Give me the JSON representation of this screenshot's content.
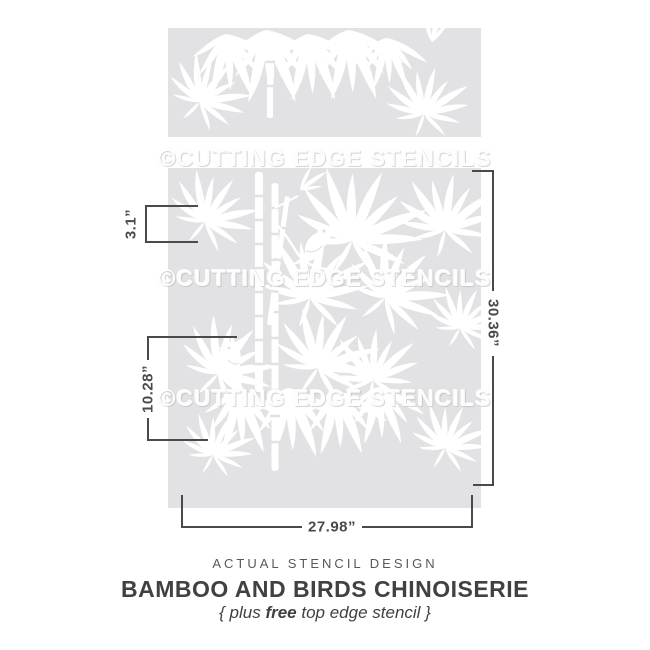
{
  "colors": {
    "stencil_fill": "#e2e2e4",
    "art_color": "#ffffff",
    "dim_line": "#4a4a4c",
    "kicker_text": "#58595b",
    "title_text": "#414042",
    "subtitle_text": "#414042",
    "page_bg": "#ffffff"
  },
  "watermark": {
    "text": "©CUTTING EDGE STENCILS"
  },
  "dimensions": {
    "top_stencil_height": "3.1”",
    "motif_height": "10.28”",
    "stencil_height": "30.36”",
    "stencil_width": "27.98”"
  },
  "caption": {
    "kicker": "ACTUAL STENCIL DESIGN",
    "title": "BAMBOO AND BIRDS CHINOISERIE",
    "subtitle_prefix": "{ plus ",
    "subtitle_emphasis": "free",
    "subtitle_suffix": " top edge stencil }"
  }
}
